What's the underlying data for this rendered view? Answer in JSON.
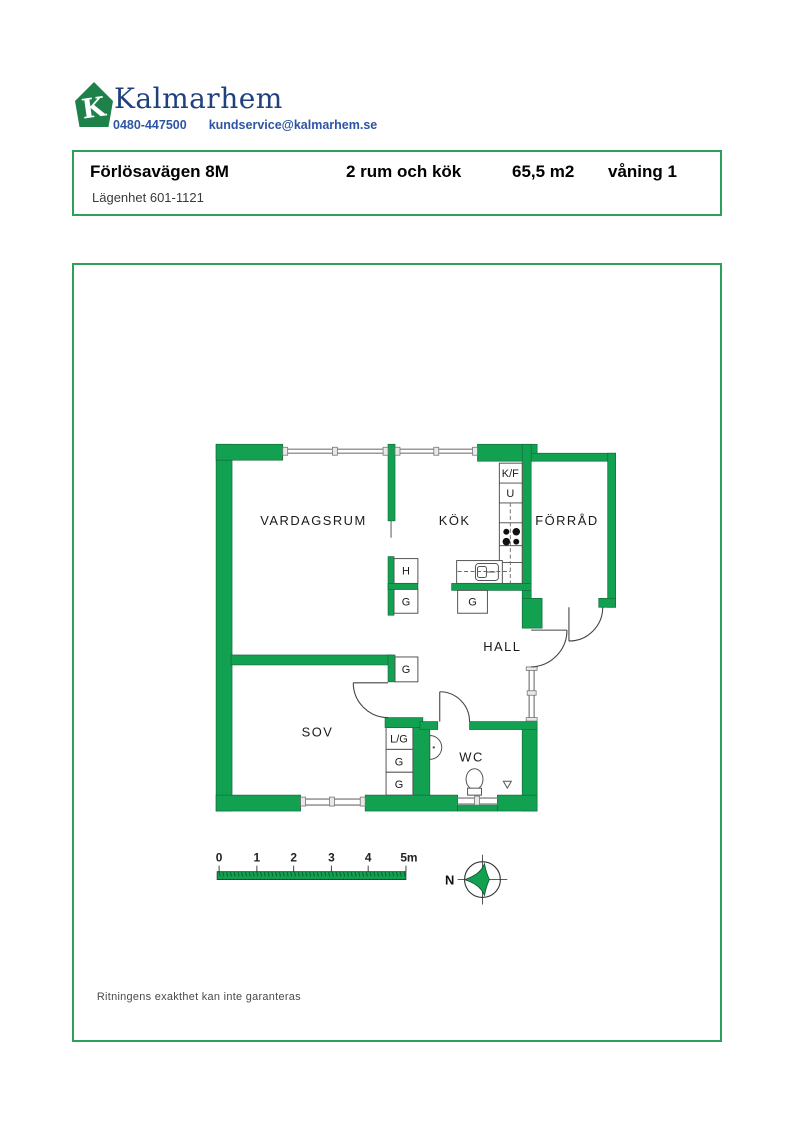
{
  "logo": {
    "letter": "K",
    "brand": "Kalmarhem",
    "phone": "0480-447500",
    "email": "kundservice@kalmarhem.se"
  },
  "header": {
    "address": "Förlösavägen 8M",
    "rooms": "2 rum och kök",
    "area": "65,5 m2",
    "floor": "våning 1",
    "apartment": "Lägenhet 601-1121"
  },
  "plan": {
    "rooms": {
      "living": "VARDAGSRUM",
      "kitchen": "KÖK",
      "storage": "FÖRRÅD",
      "hall": "HALL",
      "bedroom": "SOV",
      "wc": "WC"
    },
    "units": {
      "kf": "K/F",
      "u": "U",
      "h": "H",
      "g": "G",
      "lg": "L/G"
    },
    "scale": {
      "t0": "0",
      "t1": "1",
      "t2": "2",
      "t3": "3",
      "t4": "4",
      "t5": "5m"
    },
    "compass_north": "N"
  },
  "footer": {
    "disclaimer": "Ritningens exakthet kan inte garanteras"
  },
  "colors": {
    "wall_green": "#12a151",
    "box_border_green": "#2e9e5b",
    "logo_green": "#1e8149",
    "brand_blue": "#20417e",
    "contact_blue": "#2d55a5"
  }
}
